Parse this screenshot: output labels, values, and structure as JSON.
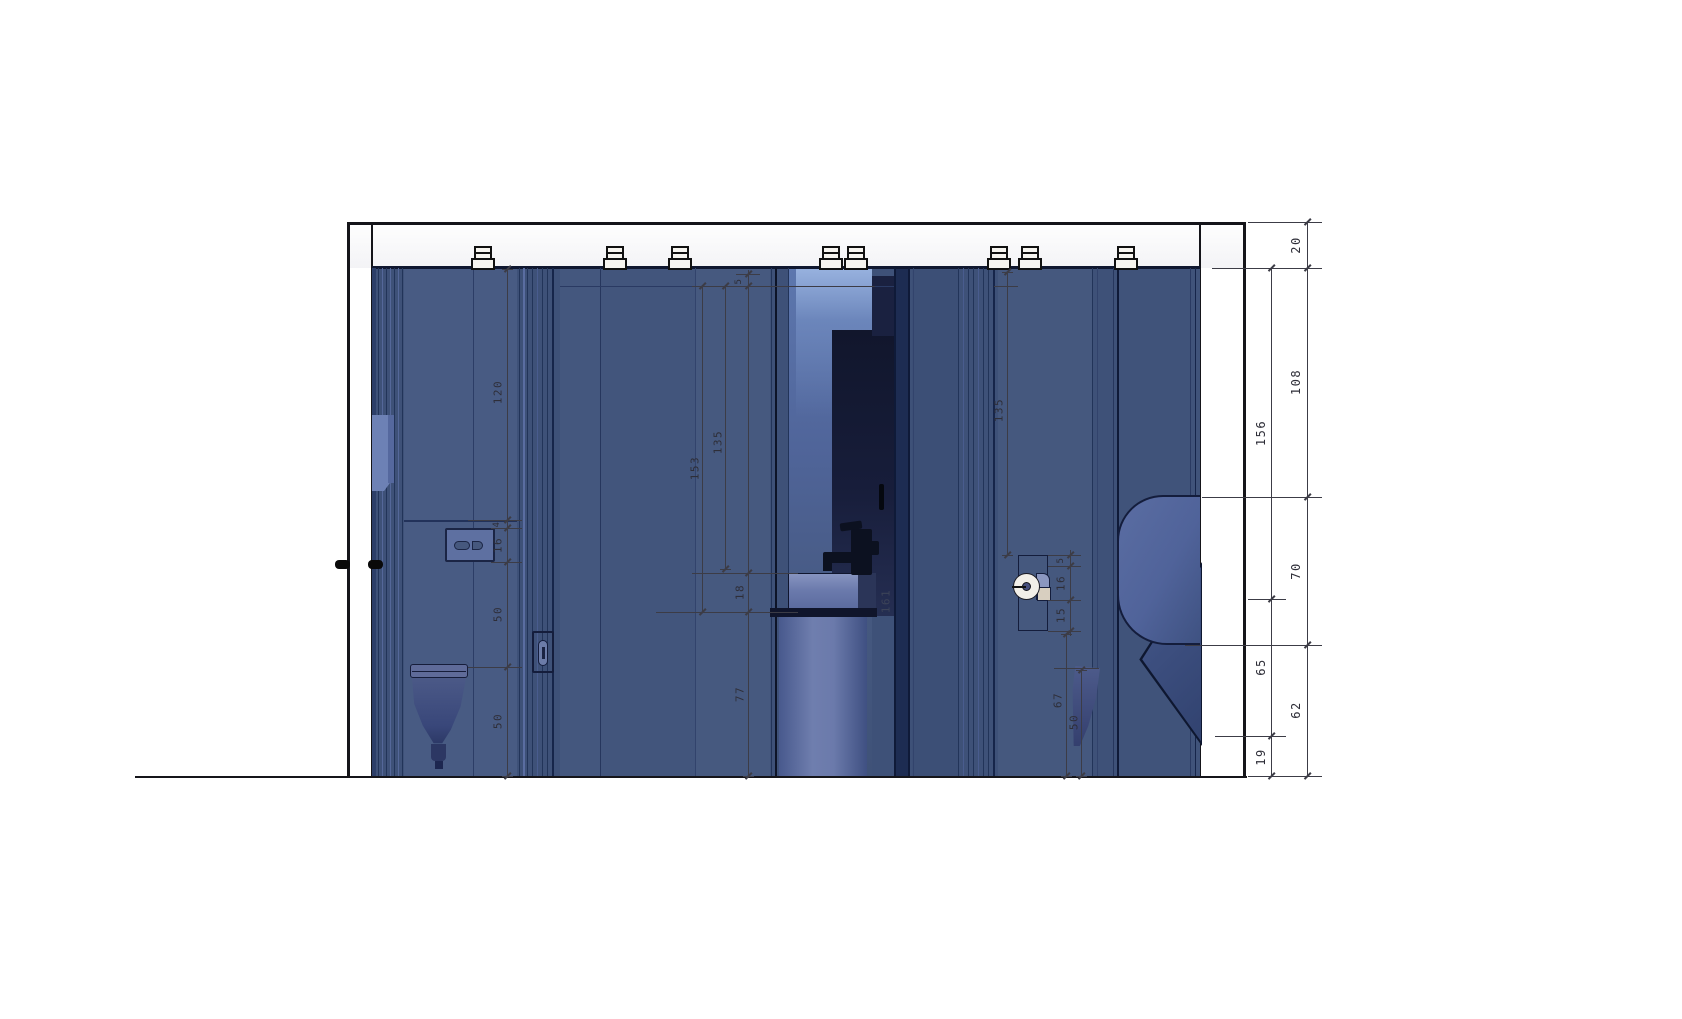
{
  "drawing": {
    "type": "sanitary-unit-interior-elevation",
    "units": "cm",
    "palette": {
      "interior_base": "#3e5178",
      "stall_panel": "#485b83",
      "mirror_recess": "#141a33",
      "highlight_glow": "#7e9cd8",
      "fixture_white": "#f2efe8",
      "line_color": "#15151a",
      "dim_color": "#2e2e38"
    },
    "dimensions": {
      "right_outer_chain": [
        "20",
        "108",
        "70",
        "62"
      ],
      "right_inner_chain": [
        "156",
        "65",
        "19"
      ],
      "left_stall": [
        "120",
        "4",
        "16",
        "50",
        "50"
      ],
      "middle_vanity": [
        "5",
        "153",
        "135",
        "18",
        "161",
        "77"
      ],
      "right_stall": [
        "135",
        "5",
        "16",
        "15",
        "67",
        "50"
      ]
    },
    "fixtures": [
      "ceiling-spotlight",
      "wall-hung-toilet",
      "flush-plate",
      "stall-door-lock",
      "mirror",
      "faucet",
      "washbasin",
      "pedestal",
      "toilet-paper-holder",
      "urinal",
      "privacy-screen",
      "door-handle"
    ]
  }
}
